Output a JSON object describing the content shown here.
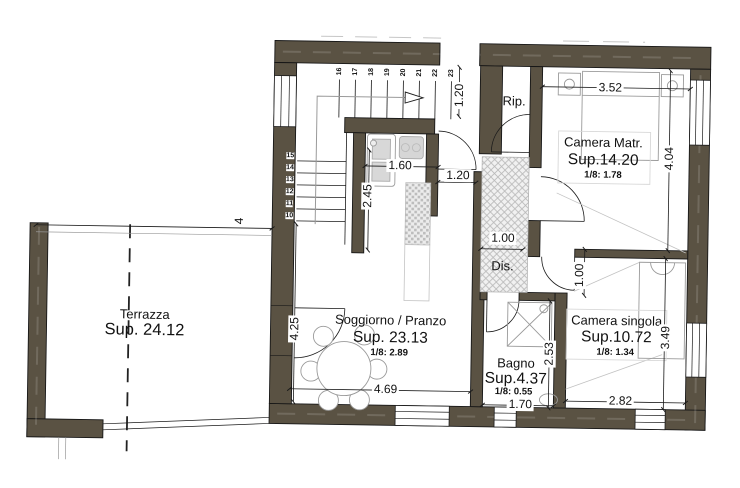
{
  "plan": {
    "title": "apartment-floor-plan",
    "rooms": {
      "terrazza": {
        "name": "Terrazza",
        "sup": "Sup. 24.12"
      },
      "soggiorno": {
        "name": "Soggiorno / Pranzo",
        "sup": "Sup. 23.13",
        "ratio": "1/8:  2.89"
      },
      "camera_matr": {
        "name": "Camera Matr.",
        "sup": "Sup.14.20",
        "ratio": "1/8:  1.78"
      },
      "camera_singola": {
        "name": "Camera singola",
        "sup": "Sup.10.72",
        "ratio": "1/8:  1.34"
      },
      "bagno": {
        "name": "Bagno",
        "sup": "Sup.4.37",
        "ratio": "1/8:  0.55"
      },
      "rip": {
        "name": "Rip."
      },
      "dis": {
        "name": "Dis."
      }
    },
    "dims": {
      "terrace_top": "4",
      "matr_w": "3.52",
      "matr_h": "4.04",
      "landing": "1.20",
      "kitchen_w": "1.60",
      "kitchen_h": "2.45",
      "hall_door": "1.20",
      "dis_w": "1.00",
      "singola_door": "1.00",
      "sogg_h": "4.25",
      "sogg_w": "4.69",
      "bagno_w": "1.70",
      "bagno_h": "2.53",
      "singola_w": "2.82",
      "singola_h": "3.49"
    },
    "stairs": {
      "lower_steps": [
        "15",
        "14",
        "13",
        "12",
        "11",
        "10"
      ],
      "upper_steps": [
        "16",
        "17",
        "18",
        "19",
        "20",
        "21",
        "22",
        "23"
      ]
    },
    "colors": {
      "wall": "#5a5243",
      "line": "#1a1a1a",
      "furniture": "#9a9a9a",
      "hatch": "#b9b9b9"
    }
  }
}
